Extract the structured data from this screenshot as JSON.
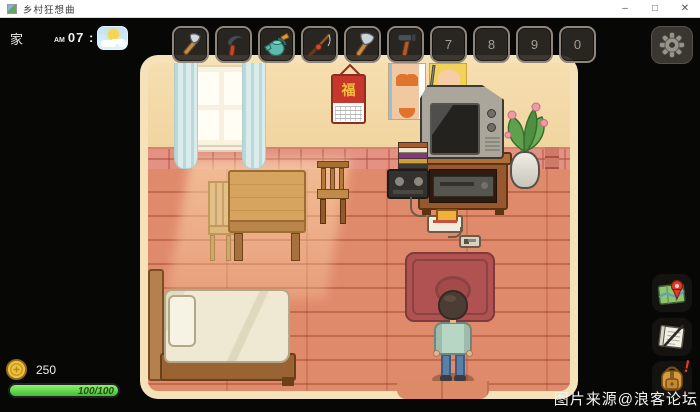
{
  "window": {
    "title": "乡村狂想曲",
    "controls": {
      "minimize": "–",
      "maximize": "□",
      "close": "✕"
    }
  },
  "hud": {
    "location": "家",
    "time": {
      "period": "AM",
      "value": "07 : 00"
    },
    "weather_icon": "sunny-with-cloud-icon",
    "money": "250",
    "health": {
      "current": 100,
      "max": 100,
      "label": "100/100"
    },
    "hotbar": {
      "slots": [
        {
          "tool": "hatchet"
        },
        {
          "tool": "sickle"
        },
        {
          "tool": "watering-can"
        },
        {
          "tool": "fishing-rod"
        },
        {
          "tool": "axe"
        },
        {
          "tool": "hammer"
        },
        {
          "label": "7"
        },
        {
          "label": "8"
        },
        {
          "label": "9"
        },
        {
          "label": "0"
        }
      ]
    },
    "menu": {
      "settings": "gear-icon",
      "map": "map-icon",
      "journal": "journal-icon",
      "backpack": "backpack-icon",
      "backpack_badge": "!"
    }
  },
  "room": {
    "calendar_char": "福",
    "objects": [
      "window",
      "curtains",
      "fu-calendar",
      "pinup-posters",
      "crt-tv",
      "tv-stand",
      "vcr",
      "magazine-stack",
      "cassette-player",
      "flower-vase",
      "retro-game-console",
      "game-controller",
      "red-carpet",
      "bed",
      "wooden-table",
      "chairs",
      "player-character"
    ]
  },
  "watermark": "图片来源@浪客论坛",
  "colors": {
    "room_border": "#f5e2b8",
    "wall": "#f3d8a5",
    "wainscot": "#e49183",
    "floor": "#e08a6c",
    "carpet": "#b05252",
    "curtain": "#d9eceb",
    "bed_blanket": "#efe9d4",
    "health_green": "#3fbf35",
    "coin_gold": "#eec13f",
    "hotbar_slot": "#2c2823",
    "calendar_red": "#c8372b",
    "calendar_gold": "#f2c23e",
    "character_sweater": "#b7d6c4",
    "character_jeans": "#5b80a8"
  }
}
